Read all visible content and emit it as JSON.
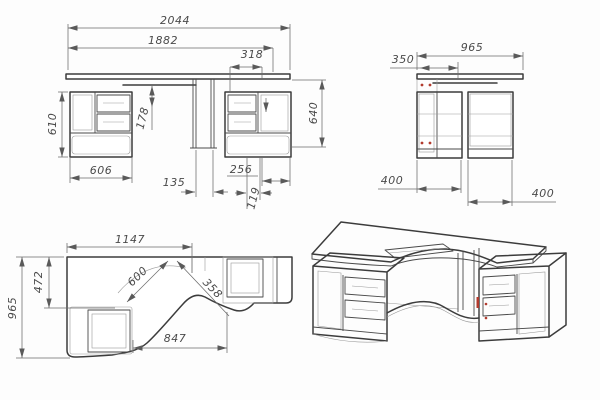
{
  "drawing": {
    "colors": {
      "background": "#fdfdfd",
      "line": "#3c3c3c",
      "dimension": "#6b6b6b",
      "accent_red": "#b23b2e"
    },
    "front_view": {
      "dims": {
        "overall_width": "2044",
        "worktop_width": "1882",
        "right_overhang": "318",
        "cabinet_height": "610",
        "tray_drop": "178",
        "desk_height": "640",
        "left_cabinet_width": "606",
        "center_gap": "135",
        "drawer_width": "256",
        "side_gap": "119"
      }
    },
    "side_view": {
      "dims": {
        "overall_depth": "965",
        "tray_depth": "350",
        "left_cabinet_depth": "400",
        "right_cabinet_depth": "400"
      }
    },
    "plan_view": {
      "dims": {
        "left_section_width": "1147",
        "corner_depth": "472",
        "overall_depth": "965",
        "cutout_radius": "600",
        "cutout_span": "358",
        "front_edge_span": "847"
      }
    }
  }
}
